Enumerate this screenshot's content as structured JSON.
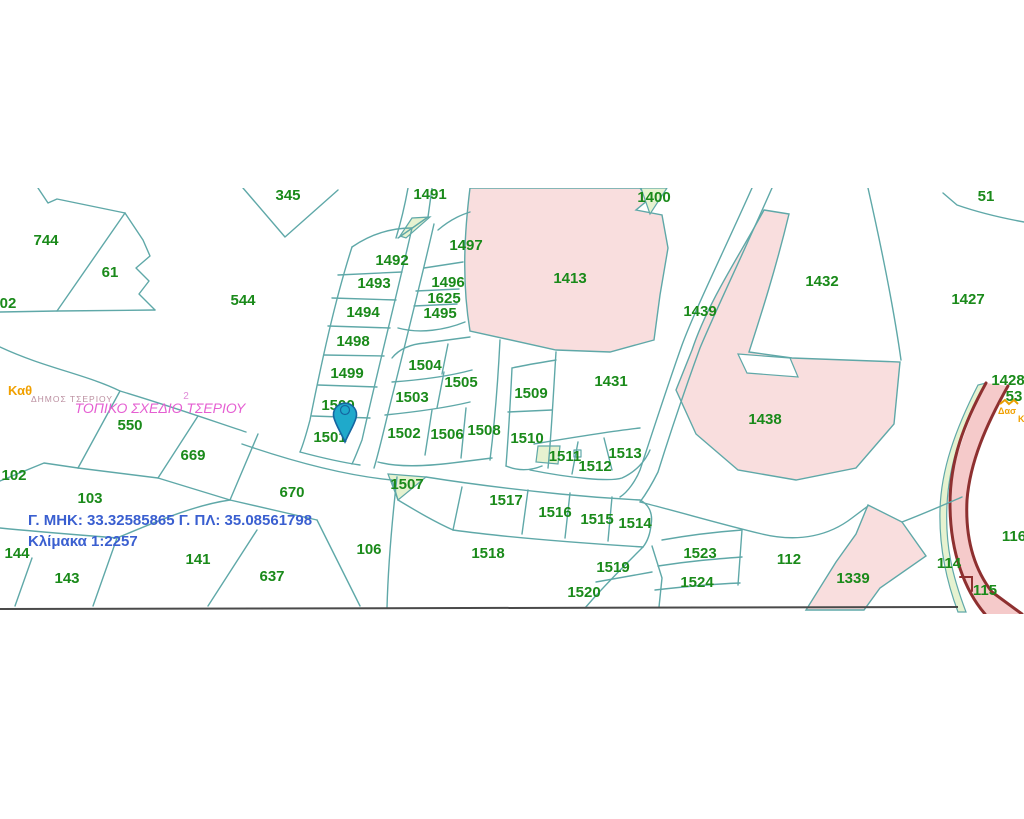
{
  "map": {
    "title_labels": {
      "municipality": "ΔΗΜΟΣ ΤΣΕΡΙΟΥ",
      "plan_name": "ΤΟΠΙΚΟ ΣΧΕΔΙΟ ΤΣΕΡΙΟΥ",
      "plan_number": "2",
      "zone_kath": "Καθ",
      "zone_das": "Δασ",
      "zone_partial": "Κ"
    },
    "info": {
      "coordinates": "Γ. ΜΗΚ: 33.32585865 Γ. ΠΛ: 35.08561798",
      "scale": "Κλίμακα 1:2257"
    },
    "marker": {
      "parcel": "1500",
      "x": 345,
      "y": 420,
      "color": "#1fa9cb"
    },
    "colors": {
      "parcel_text": "#1a8a1a",
      "boundary": "#5fa8a8",
      "pink_area": "#f9dede",
      "green_area": "#e6f2d0",
      "road_fill": "#f5caca",
      "road_border": "#8e3030",
      "coords_text": "#3a5fd0",
      "plan_text": "#e55fd2",
      "municipality_text": "#bb8fa0",
      "zone_text": "#f0a000"
    },
    "parcels": [
      {
        "n": "345",
        "x": 288,
        "y": 195,
        "partial": true
      },
      {
        "n": "1491",
        "x": 430,
        "y": 194,
        "partial": true
      },
      {
        "n": "1400",
        "x": 654,
        "y": 197,
        "partial": true
      },
      {
        "n": "51",
        "x": 986,
        "y": 196,
        "partial": true
      },
      {
        "n": "744",
        "x": 46,
        "y": 240
      },
      {
        "n": "61",
        "x": 110,
        "y": 272
      },
      {
        "n": "544",
        "x": 243,
        "y": 300
      },
      {
        "n": "02",
        "x": 8,
        "y": 303,
        "partial": true
      },
      {
        "n": "550",
        "x": 130,
        "y": 425
      },
      {
        "n": "669",
        "x": 193,
        "y": 455
      },
      {
        "n": "102",
        "x": 14,
        "y": 475
      },
      {
        "n": "103",
        "x": 90,
        "y": 498
      },
      {
        "n": "670",
        "x": 292,
        "y": 492
      },
      {
        "n": "144",
        "x": 17,
        "y": 553
      },
      {
        "n": "143",
        "x": 67,
        "y": 578
      },
      {
        "n": "141",
        "x": 198,
        "y": 559
      },
      {
        "n": "637",
        "x": 272,
        "y": 576
      },
      {
        "n": "106",
        "x": 369,
        "y": 549
      },
      {
        "n": "1492",
        "x": 392,
        "y": 260
      },
      {
        "n": "1493",
        "x": 374,
        "y": 283
      },
      {
        "n": "1494",
        "x": 363,
        "y": 312
      },
      {
        "n": "1498",
        "x": 353,
        "y": 341
      },
      {
        "n": "1499",
        "x": 347,
        "y": 373
      },
      {
        "n": "1500",
        "x": 338,
        "y": 405
      },
      {
        "n": "1501",
        "x": 330,
        "y": 437
      },
      {
        "n": "1497",
        "x": 466,
        "y": 245
      },
      {
        "n": "1496",
        "x": 448,
        "y": 282
      },
      {
        "n": "1625",
        "x": 444,
        "y": 298
      },
      {
        "n": "1495",
        "x": 440,
        "y": 313
      },
      {
        "n": "1504",
        "x": 425,
        "y": 365
      },
      {
        "n": "1505",
        "x": 461,
        "y": 382
      },
      {
        "n": "1503",
        "x": 412,
        "y": 397
      },
      {
        "n": "1502",
        "x": 404,
        "y": 433
      },
      {
        "n": "1506",
        "x": 447,
        "y": 434
      },
      {
        "n": "1508",
        "x": 484,
        "y": 430
      },
      {
        "n": "1509",
        "x": 531,
        "y": 393
      },
      {
        "n": "1510",
        "x": 527,
        "y": 438
      },
      {
        "n": "1511",
        "x": 565,
        "y": 456
      },
      {
        "n": "1512",
        "x": 595,
        "y": 466
      },
      {
        "n": "1513",
        "x": 625,
        "y": 453
      },
      {
        "n": "1507",
        "x": 407,
        "y": 484
      },
      {
        "n": "1517",
        "x": 506,
        "y": 500
      },
      {
        "n": "1516",
        "x": 555,
        "y": 512
      },
      {
        "n": "1515",
        "x": 597,
        "y": 519
      },
      {
        "n": "1514",
        "x": 635,
        "y": 523
      },
      {
        "n": "1518",
        "x": 488,
        "y": 553
      },
      {
        "n": "1519",
        "x": 613,
        "y": 567
      },
      {
        "n": "1520",
        "x": 584,
        "y": 592
      },
      {
        "n": "1523",
        "x": 700,
        "y": 553
      },
      {
        "n": "1524",
        "x": 697,
        "y": 582
      },
      {
        "n": "112",
        "x": 789,
        "y": 559
      },
      {
        "n": "1339",
        "x": 853,
        "y": 578
      },
      {
        "n": "114",
        "x": 949,
        "y": 563
      },
      {
        "n": "115",
        "x": 985,
        "y": 590
      },
      {
        "n": "116",
        "x": 1014,
        "y": 536,
        "partial": true
      },
      {
        "n": "1413",
        "x": 570,
        "y": 278
      },
      {
        "n": "1431",
        "x": 611,
        "y": 381
      },
      {
        "n": "1432",
        "x": 822,
        "y": 281
      },
      {
        "n": "1439",
        "x": 700,
        "y": 311
      },
      {
        "n": "1438",
        "x": 765,
        "y": 419
      },
      {
        "n": "1427",
        "x": 968,
        "y": 299
      },
      {
        "n": "1428",
        "x": 1008,
        "y": 380,
        "partial": true
      },
      {
        "n": "53",
        "x": 1014,
        "y": 396,
        "partial": true
      }
    ]
  }
}
